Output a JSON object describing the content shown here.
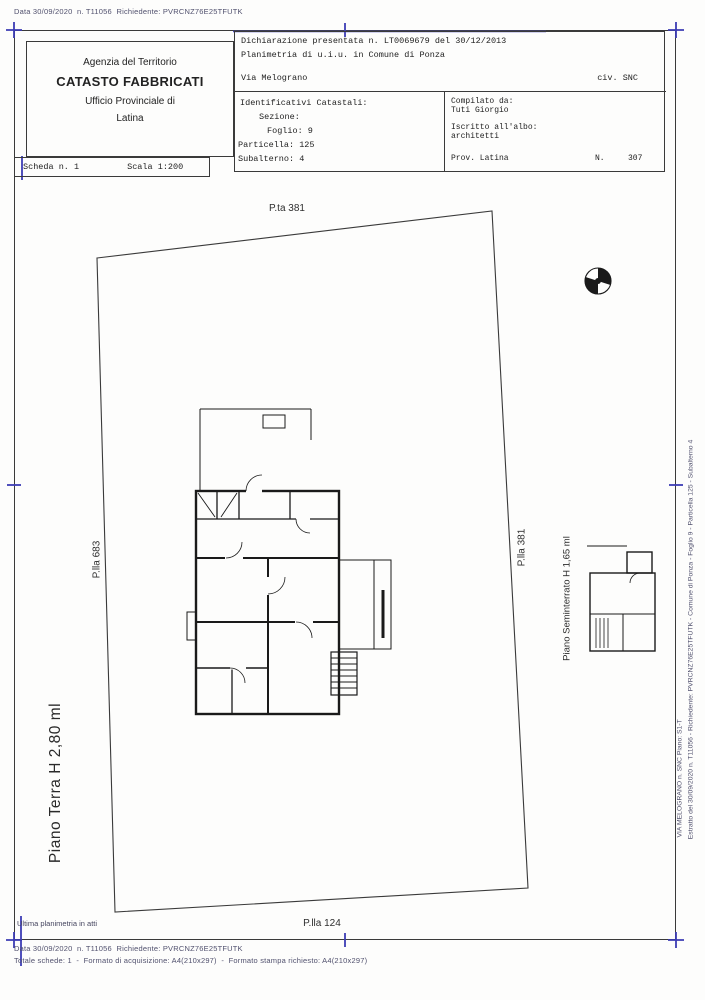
{
  "meta": {
    "top_line": "Data 30/09/2020  n. T11056  Richiedente: PVRCNZ76E25TFUTK"
  },
  "header": {
    "agency": {
      "dept": "Agenzia del Territorio",
      "title": "CATASTO FABBRICATI",
      "office": "Ufficio Provinciale di",
      "city": "Latina"
    },
    "sheet": {
      "scheda": "Scheda n. 1",
      "scala": "Scala 1:200"
    },
    "declaration": {
      "line1": "Dichiarazione presentata n. LT0069679 del 30/12/2013",
      "line2": "Planimetria di u.i.u. in Comune di Ponza",
      "street": "Via Melograno",
      "civic": "civ. SNC"
    },
    "identifiers": {
      "title": "Identificativi Catastali:",
      "sezione": "Sezione:",
      "foglio": "Foglio: 9",
      "particella": "Particella: 125",
      "subalterno": "Subalterno: 4"
    },
    "compiler": {
      "label": "Compilato da:",
      "name": "Tuti Giorgio",
      "albo_label": "Iscritto all'albo:",
      "albo": "architetti",
      "prov": "Prov. Latina",
      "n_label": "N.",
      "n_value": "307"
    }
  },
  "plan": {
    "parcel_top": "P.ta 381",
    "parcel_left": "P.lla 683",
    "parcel_right": "P.lla 381",
    "parcel_bottom": "P.lla 124",
    "floor_main": "Piano Terra H 2,80 ml",
    "floor_basement": "Piano Seminterrato H 1,65 ml",
    "note": "Ultima planimetria in atti"
  },
  "footer": {
    "line1": "Data 30/09/2020  n. T11056  Richiedente: PVRCNZ76E25TFUTK",
    "line2": "Totale schede: 1  -  Formato di acquisizione: A4(210x297)  -  Formato stampa richiesto: A4(210x297)"
  },
  "right_margin": {
    "line1": "Estratto del 30/09/2020 n. T11056 - Richiedente: PVRCNZ76E25TFUTK - Comune di Ponza - Foglio 9 - Particella 125 - Subalterno 4",
    "line2": "VIA MELOGRANO n. SNC Piano: S1-T"
  },
  "colors": {
    "registration_blue": "#3c3cb4",
    "ink": "#1a1a1a",
    "muted": "#51516e"
  }
}
